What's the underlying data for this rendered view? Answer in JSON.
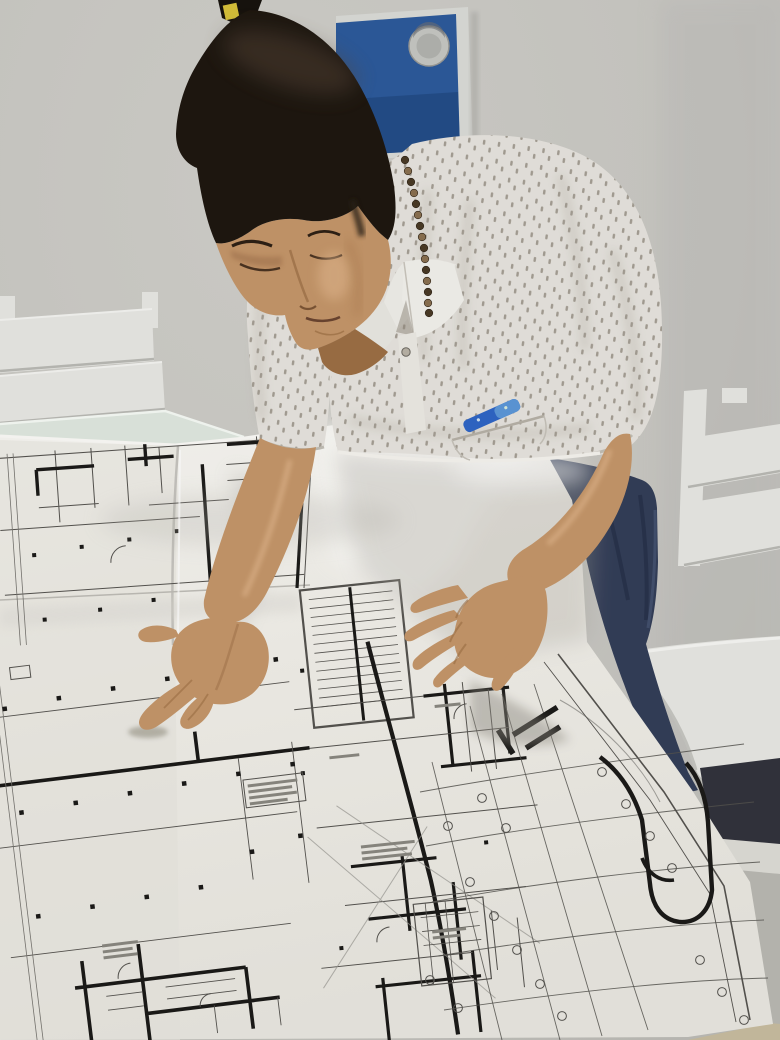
{
  "scene": {
    "colors": {
      "wall": "#c9c8c3",
      "wall_shadow": "#b6b5b0",
      "board_blue": "#2d5a9b",
      "board_blue_dark": "#1e4378",
      "board_frame": "#dadbd7",
      "grommet": "#c6c7c3",
      "marker_yellow": "#d8c23a",
      "marker_dark": "#17130e",
      "hair": "#1e1710",
      "hair_sheen": "#5a4a3a",
      "skin": "#c5966a",
      "skin_shadow": "#9c6f45",
      "skin_light": "#e6bd92",
      "shirt": "#e7e4de",
      "shirt_shadow": "#c2beb5",
      "shirt_pattern": "#6f6557",
      "collar": "#efeee9",
      "button": "#b9b3a7",
      "jeans": "#333e58",
      "jeans_fold": "#27314a",
      "pen_blue": "#2f66c6",
      "pen_blue_light": "#5c97d8",
      "bead_dark": "#4a3a26",
      "bead_light": "#8a7050",
      "paper": "#f2f0ea",
      "paper_bright": "#fbfaf7",
      "paper_shadow": "#d8d6cf",
      "line_thin": "#55534f",
      "line_thick": "#1b1a18",
      "line_faint": "#8a8880",
      "chair_white": "#e8e8e4",
      "chair_edge": "#bdbdb8",
      "glass_edge": "#dfe8df",
      "under_seat": "#32333c",
      "floor_gray": "#b9b8b2",
      "floor_tan": "#c8bc9f"
    }
  }
}
